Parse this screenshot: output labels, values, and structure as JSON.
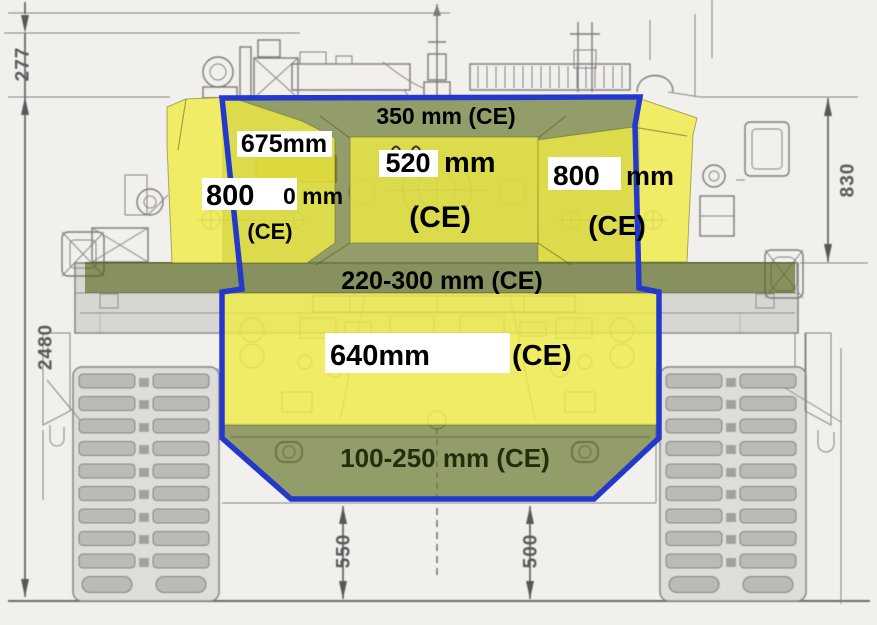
{
  "meta": {
    "description": "Front-view tank technical drawing with overlaid armor protection estimates (CE = chemical energy equivalent, in mm)"
  },
  "colors": {
    "armor_yellow": "#efeb43",
    "armor_olive": "#465a00",
    "outline_blue": "#2438cc",
    "label_box": "#ffffff",
    "label_text": "#000000",
    "glacis_text": "#212f0c",
    "drawing_gray": "#6f6f6f",
    "paper": "#f2f0ec"
  },
  "armor": {
    "turret_roof": {
      "label": "350 mm (CE)"
    },
    "left_cheek": {
      "upper_value": "675mm",
      "value": "800",
      "remnant": "0 mm",
      "ce": "(CE)"
    },
    "mantlet": {
      "value": "520",
      "unit": "mm",
      "ce": "(CE)"
    },
    "right_cheek": {
      "value": "800",
      "unit": "mm",
      "ce": "(CE)"
    },
    "hull_top": {
      "label": "220-300 mm (CE)"
    },
    "hull_front": {
      "value": "640mm",
      "ce": "(CE)"
    },
    "lower_glacis": {
      "label": "100-250 mm (CE)"
    }
  },
  "dimensions": {
    "top": "277",
    "left": "2480",
    "right": "830",
    "bottom_left": "550",
    "bottom_right": "500"
  }
}
